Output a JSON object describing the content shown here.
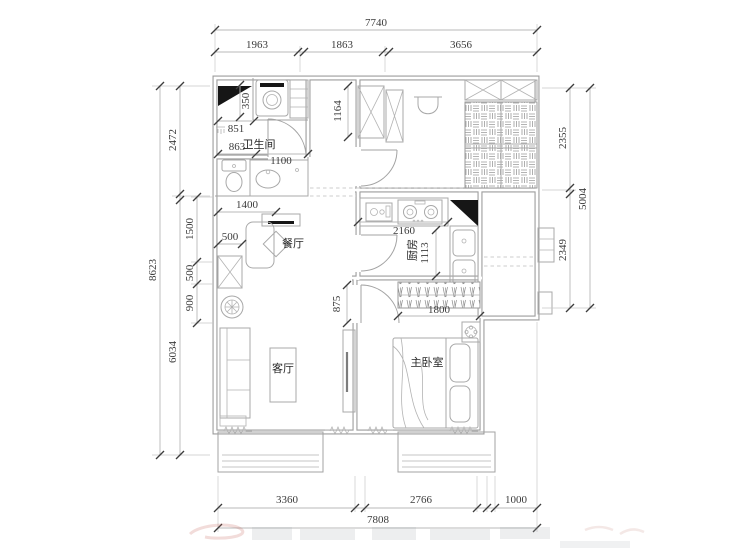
{
  "drawing": {
    "kind": "apartment floor plan",
    "rooms": {
      "bathroom": "卫生间",
      "dining": "餐厅",
      "kitchen": "厨房",
      "living_room": "客厅",
      "master_bedroom": "主卧室"
    },
    "dims": {
      "top": {
        "total": "7740",
        "segments": [
          "1963",
          "1863",
          "3656"
        ]
      },
      "bottom": {
        "total": "7808",
        "segments": [
          "3360",
          "2766",
          "1000"
        ]
      },
      "left": {
        "total": "8623",
        "segments": [
          "2472",
          "6034"
        ],
        "inner": [
          "1500",
          "500",
          "900"
        ]
      },
      "right": {
        "total": "5004",
        "segments": [
          "2355",
          "2349"
        ]
      },
      "interior": {
        "flue_width": "350",
        "bath_top_width": "851",
        "bath_left_width": "863",
        "bath_door": "1100",
        "entry_width": "1400",
        "dining_cabinet": "500",
        "closet_depth": "1164",
        "kitchen_width": "2160",
        "kitchen_depth": "1113",
        "bedroom_door": "875",
        "wardrobe_width": "1800"
      }
    }
  }
}
